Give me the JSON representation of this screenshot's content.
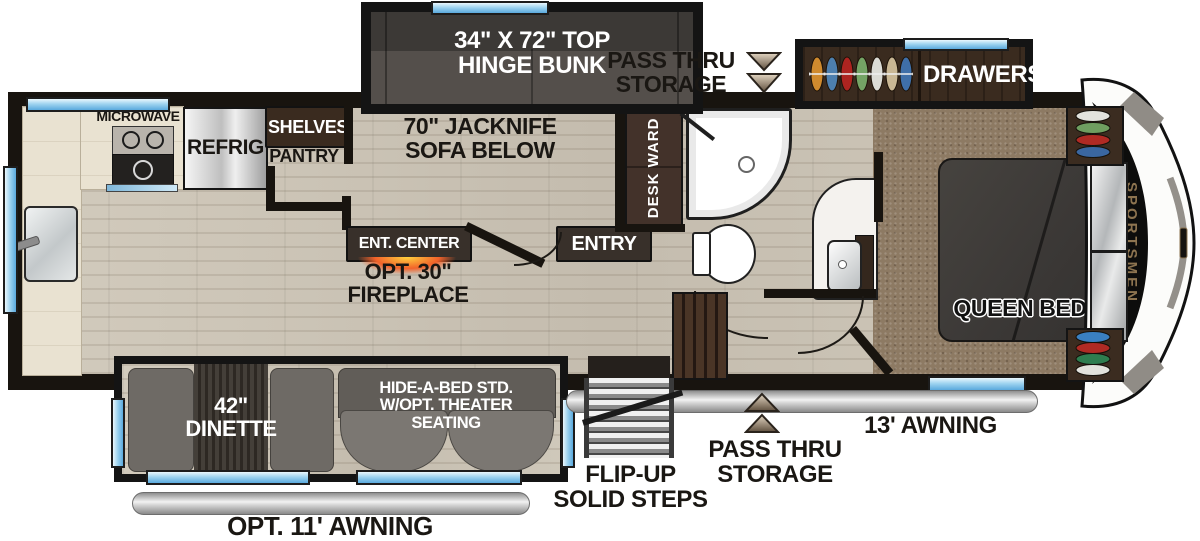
{
  "plan_title": "RV fifth-wheel floorplan",
  "brand": {
    "name": "SPORTSMEN"
  },
  "kitchen": {
    "microwave": "MICROWAVE",
    "refrig": "REFRIG",
    "shelves": "SHELVES",
    "pantry": "PANTRY"
  },
  "living": {
    "bunk_line1": "34\" X 72\" TOP",
    "bunk_line2": "HINGE BUNK",
    "sofa_line1": "70\" JACKNIFE",
    "sofa_line2": "SOFA BELOW",
    "ent_center": "ENT. CENTER",
    "fireplace_line1": "OPT. 30\"",
    "fireplace_line2": "FIREPLACE",
    "entry": "ENTRY",
    "desk_ward": "DESK WARD"
  },
  "bedroom": {
    "queen_bed": "QUEEN BED",
    "drawers": "DRAWERS"
  },
  "dinette": {
    "line1": "42\"",
    "line2": "DINETTE"
  },
  "hide_a_bed": {
    "line1": "HIDE-A-BED STD.",
    "line2": "W/OPT. THEATER",
    "line3": "SEATING"
  },
  "exterior": {
    "pass_thru_top_line1": "PASS THRU",
    "pass_thru_top_line2": "STORAGE",
    "pass_thru_bottom_line1": "PASS THRU",
    "pass_thru_bottom_line2": "STORAGE",
    "awning_13": "13' AWNING",
    "awning_11": "OPT. 11' AWNING",
    "steps_line1": "FLIP-UP",
    "steps_line2": "SOLID STEPS"
  },
  "colors": {
    "wall": "#18140f",
    "window_blue": "#9fd4f0",
    "wood_floor": "#cbc4b6",
    "carpet": "#8d7a63",
    "dark_cabinet": "#3a2b1f",
    "furniture_gray": "#716d67",
    "fireplace_glow": "#f2622a",
    "awning_gray": "#cfcfcf",
    "brand_gold": "#8d7450"
  }
}
